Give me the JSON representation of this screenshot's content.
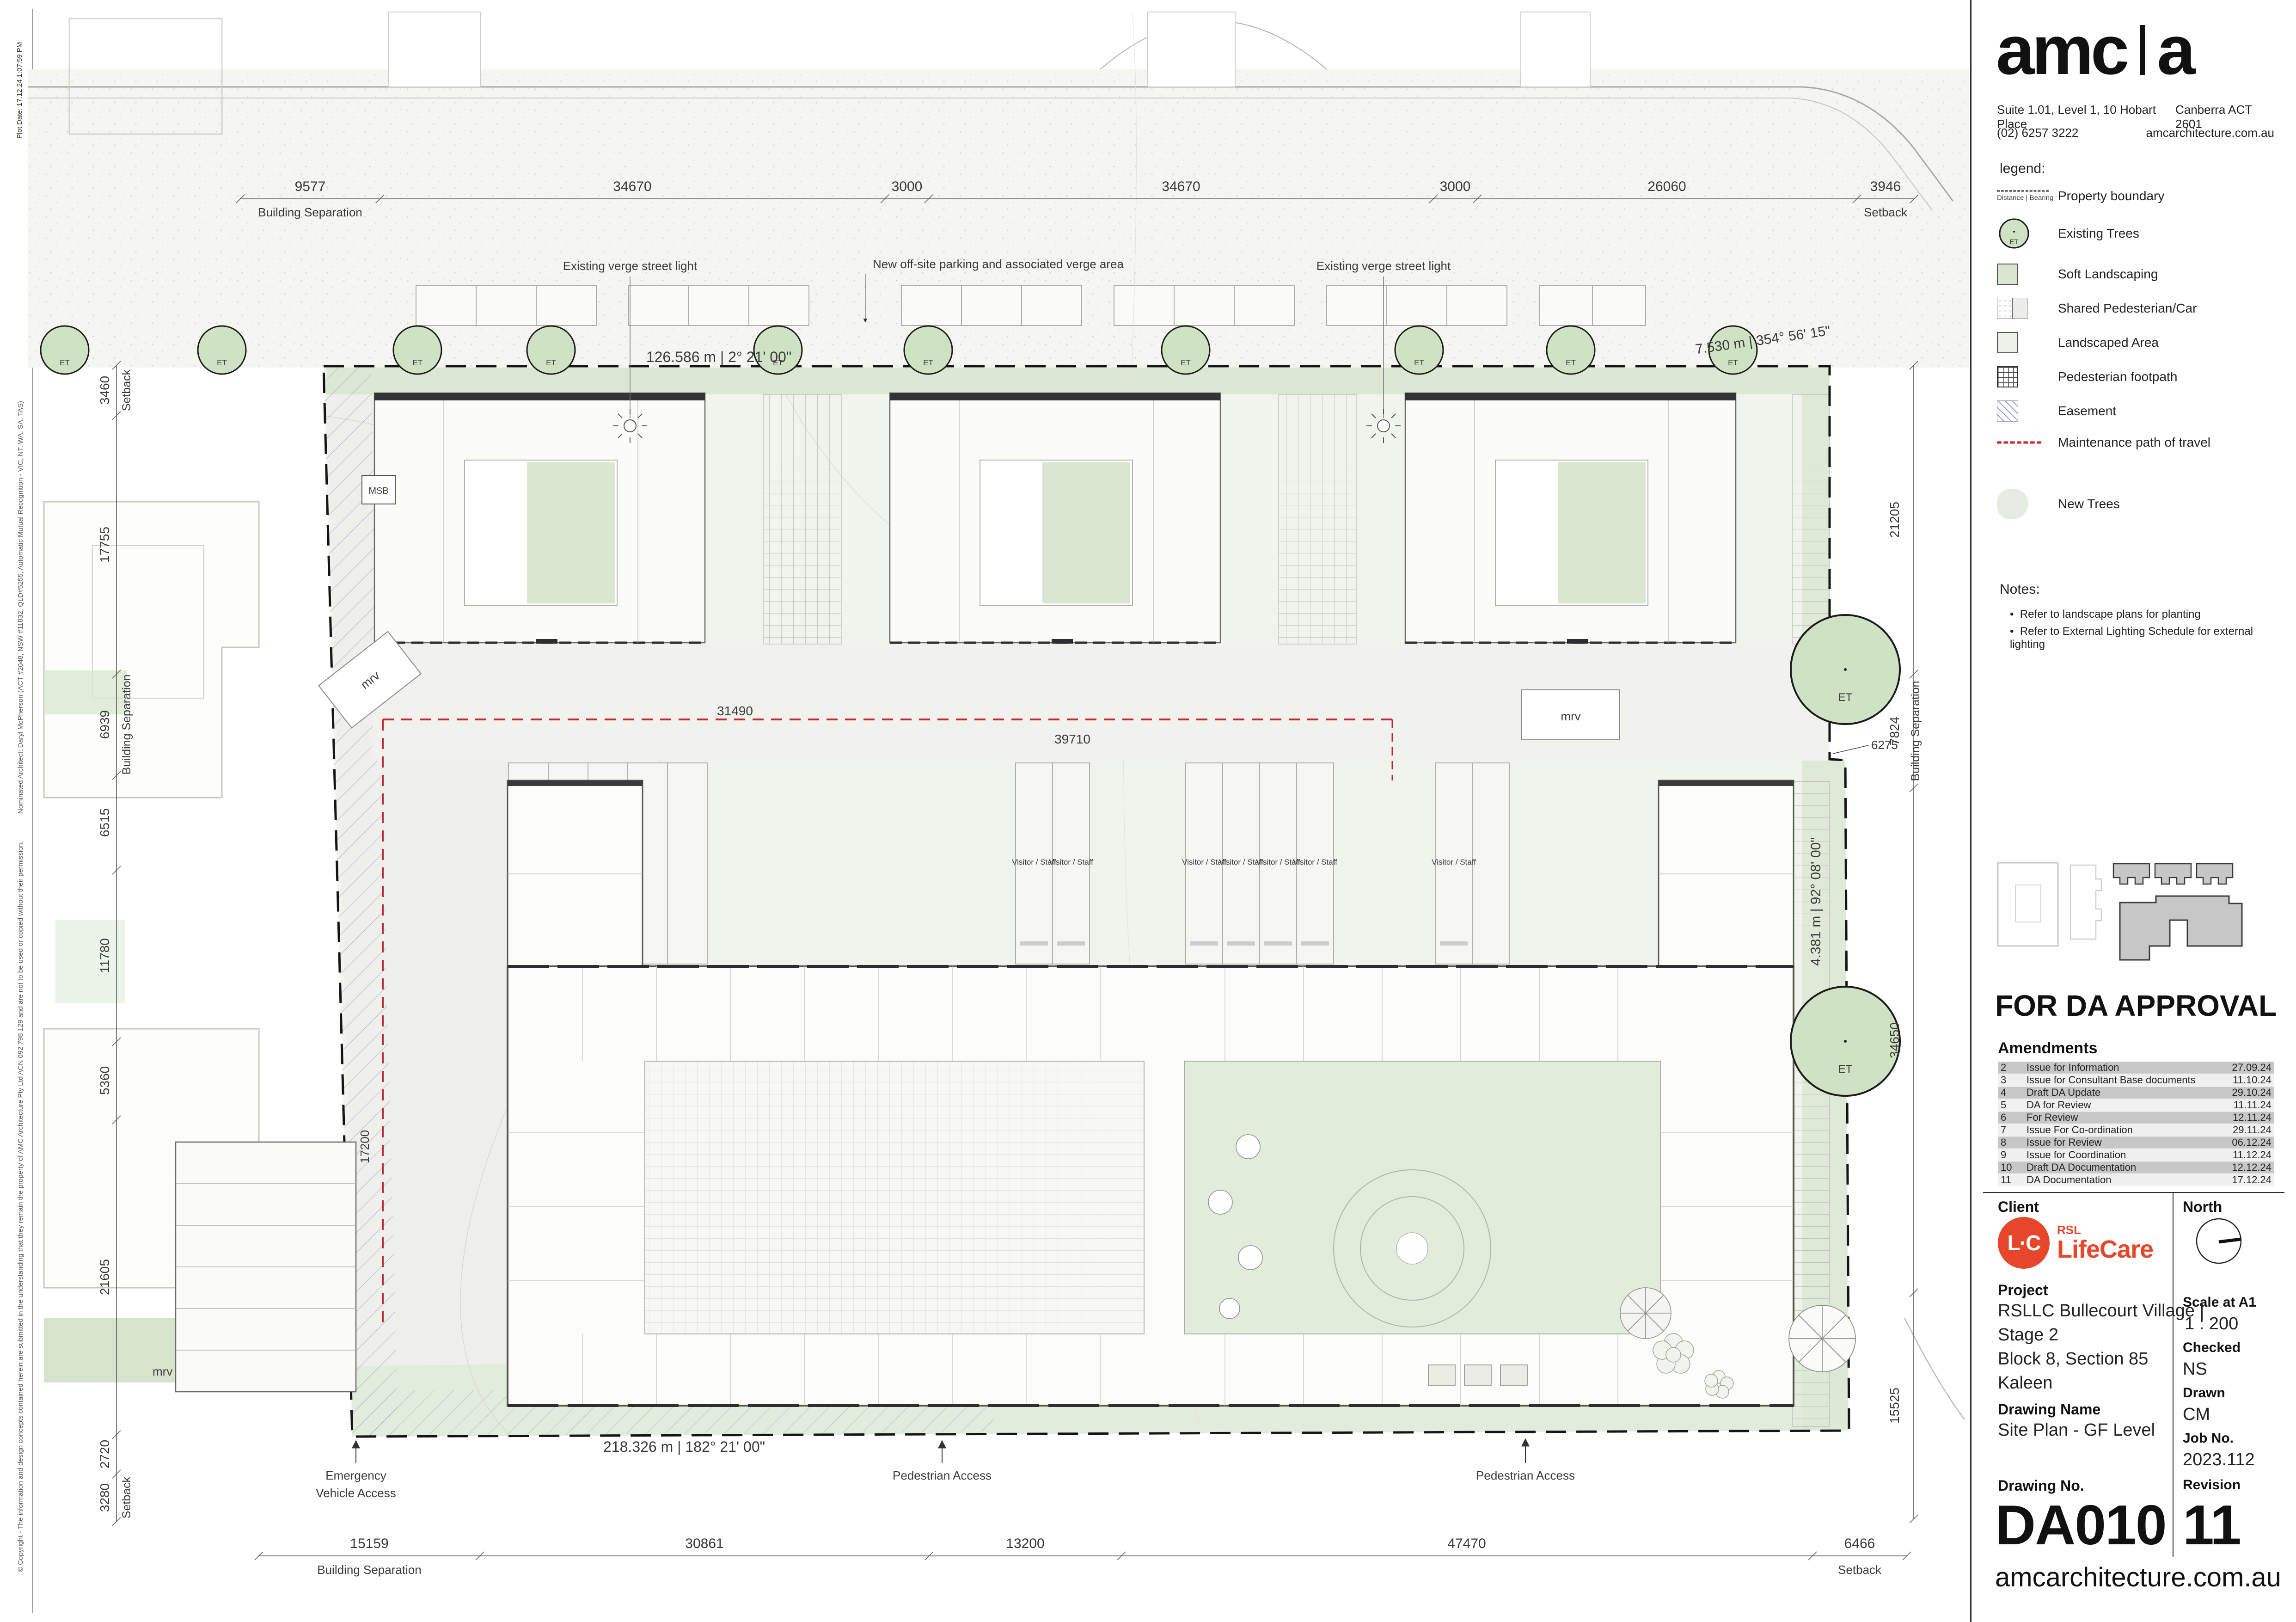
{
  "edge": {
    "plot_date": "Plot Date: 17.12.24 1:07:59 PM",
    "architect_note": "Nominated Architect: Daryl McPherson (ACT #2048, NSW #11832, QLD#5255, Automatic Mutual Recognition - VIC, NT, WA, SA, TAS)",
    "copyright_note": "© Copyright - The information and design concepts contained herein are submitted in the understanding that they remain the property of AMC Architecture Pty Ltd ACN 092 798 129 and are not to be used or copied without their permission."
  },
  "firm": {
    "logo_left": "amc",
    "logo_right": "a",
    "address_left": "Suite 1.01, Level 1, 10 Hobart Place",
    "address_right": "Canberra ACT 2601",
    "phone": "(02) 6257 3222",
    "website": "amcarchitecture.com.au"
  },
  "legend": {
    "title": "legend:",
    "tree_label": "ET",
    "boundary_caption": "Distance | Bearing",
    "items": [
      {
        "label": "Property boundary"
      },
      {
        "label": "Existing Trees"
      },
      {
        "label": "Soft Landscaping"
      },
      {
        "label": "Shared Pedesterian/Car"
      },
      {
        "label": "Landscaped Area"
      },
      {
        "label": "Pedesterian footpath"
      },
      {
        "label": "Easement"
      },
      {
        "label": "Maintenance path of travel"
      },
      {
        "label": "New Trees"
      }
    ]
  },
  "notes": {
    "title": "Notes:",
    "items": [
      "Refer to landscape plans for planting",
      "Refer to External Lighting Schedule for external lighting"
    ]
  },
  "approval": "FOR DA APPROVAL",
  "amendments": {
    "title": "Amendments",
    "rows": [
      {
        "no": "2",
        "desc": "Issue for Information",
        "date": "27.09.24"
      },
      {
        "no": "3",
        "desc": "Issue for Consultant Base documents",
        "date": "11.10.24"
      },
      {
        "no": "4",
        "desc": "Draft DA Update",
        "date": "29.10.24"
      },
      {
        "no": "5",
        "desc": "DA for Review",
        "date": "11.11.24"
      },
      {
        "no": "6",
        "desc": "For Review",
        "date": "12.11.24"
      },
      {
        "no": "7",
        "desc": "Issue For Co-ordination",
        "date": "29.11.24"
      },
      {
        "no": "8",
        "desc": "Issue for Review",
        "date": "06.12.24"
      },
      {
        "no": "9",
        "desc": "Issue for Coordination",
        "date": "11.12.24"
      },
      {
        "no": "10",
        "desc": "Draft DA Documentation",
        "date": "12.12.24"
      },
      {
        "no": "11",
        "desc": "DA Documentation",
        "date": "17.12.24"
      }
    ]
  },
  "titleblock": {
    "client_label": "Client",
    "north_label": "North",
    "client_logo": {
      "mark": "L·C",
      "rsl": "RSL",
      "lifecare": "LifeCare"
    },
    "project_label": "Project",
    "project_lines": [
      "RSLLC Bullecourt Village |",
      "Stage 2",
      "Block 8, Section 85",
      "Kaleen"
    ],
    "drawing_name_label": "Drawing Name",
    "drawing_name": "Site Plan - GF Level",
    "scale_label": "Scale at A1",
    "scale": "1 : 200",
    "checked_label": "Checked",
    "checked": "NS",
    "drawn_label": "Drawn",
    "drawn": "CM",
    "job_label": "Job No.",
    "job": "2023.112",
    "drawing_no_label": "Drawing No.",
    "drawing_no": "DA010",
    "revision_label": "Revision",
    "revision": "11",
    "footer": "amcarchitecture.com.au"
  },
  "colors": {
    "maintenance_red": "#c1272d",
    "rsl_orange": "#e8462a",
    "tree_green": "#cfe3c4",
    "soft_landscape": "#d9e7d1",
    "easement_blue": "#9aa0cf"
  },
  "plan": {
    "tree_label": "ET",
    "parking_bay_label": "Visitor / Staff",
    "msb": "MSB",
    "mrv": "mrv",
    "street_light_label": "Existing verge street light",
    "parking_note": "New off-site parking and associated verge area",
    "emergency_access_1": "Emergency",
    "emergency_access_2": "Vehicle Access",
    "pedestrian_access": "Pedestrian Access",
    "bearing_top": "126.586 m | 2° 21' 00\"",
    "bearing_top_right": "7.530 m | 354° 56' 15\"",
    "bearing_bottom": "218.326 m | 182° 21' 00\"",
    "bearing_right": "4.381 m | 92° 08' 00\"",
    "dim_31490": "31490",
    "dim_39710": "39710",
    "dim_17200": "17200",
    "dim_6275": "6275",
    "top_dims": [
      {
        "v": "9577",
        "sub": "Building Separation"
      },
      {
        "v": "34670"
      },
      {
        "v": "3000"
      },
      {
        "v": "34670"
      },
      {
        "v": "3000"
      },
      {
        "v": "26060"
      },
      {
        "v": "3946",
        "sub": "Setback"
      }
    ],
    "left_dims": [
      {
        "v": "3460",
        "sub": "Setback"
      },
      {
        "v": "17755"
      },
      {
        "v": "6939",
        "sub": "Building Separation"
      },
      {
        "v": "6515"
      },
      {
        "v": "11780"
      },
      {
        "v": "5360"
      },
      {
        "v": "21605"
      },
      {
        "v": "2720"
      },
      {
        "v": "3280",
        "sub": "Setback"
      }
    ],
    "right_dims": [
      {
        "v": "21205"
      },
      {
        "v": "7824",
        "sub": "Building Separation"
      },
      {
        "v": "34650"
      },
      {
        "v": "15525"
      }
    ],
    "bottom_dims": [
      {
        "v": "15159",
        "sub": "Building Separation"
      },
      {
        "v": "30861"
      },
      {
        "v": "13200"
      },
      {
        "v": "47470"
      },
      {
        "v": "6466",
        "sub": "Setback"
      }
    ]
  }
}
